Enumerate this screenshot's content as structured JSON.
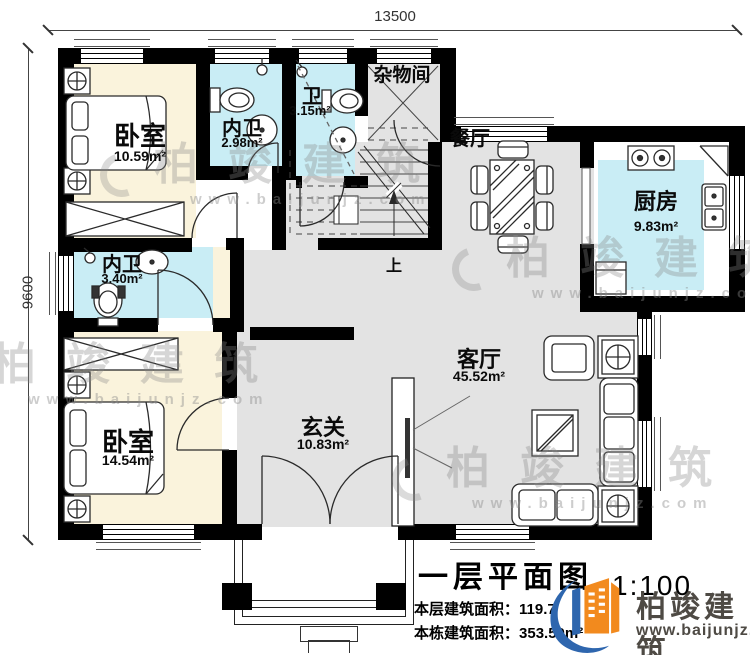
{
  "dimensions": {
    "width": "13500",
    "height": "9600"
  },
  "rooms": {
    "bedroom1": {
      "name": "卧室",
      "area": "10.59m²"
    },
    "inner_bath1": {
      "name": "内卫",
      "area": "2.98m²"
    },
    "bath": {
      "name": "卫",
      "area": "3.15m²"
    },
    "storage": {
      "name": "杂物间"
    },
    "dining": {
      "name": "餐厅"
    },
    "kitchen": {
      "name": "厨房",
      "area": "9.83m²"
    },
    "inner_bath2": {
      "name": "内卫",
      "area": "3.40m²"
    },
    "bedroom2": {
      "name": "卧室",
      "area": "14.54m²"
    },
    "foyer": {
      "name": "玄关",
      "area": "10.83m²"
    },
    "living": {
      "name": "客厅",
      "area": "45.52m²"
    }
  },
  "stairs": {
    "up": "上"
  },
  "title_block": {
    "title": "一层平面图",
    "scale": "1:100",
    "floor_area_label": "本层建筑面积：",
    "floor_area_value": "119.7",
    "building_area_label": "本栋建筑面积：",
    "building_area_value": "353.50m²"
  },
  "brand": {
    "name": "柏竣建筑",
    "url": "www.baijunjz.com"
  },
  "watermark": {
    "name": "柏竣建筑",
    "url": "www.baijunjz.com"
  },
  "colors": {
    "bedroom_fill": "#faf3dc",
    "bath_fill": "#c9edf5",
    "floor_fill": "#e3e3e3",
    "wall": "#000000",
    "brand_orange": "#f28a1e",
    "brand_blue": "#2e66ae"
  }
}
